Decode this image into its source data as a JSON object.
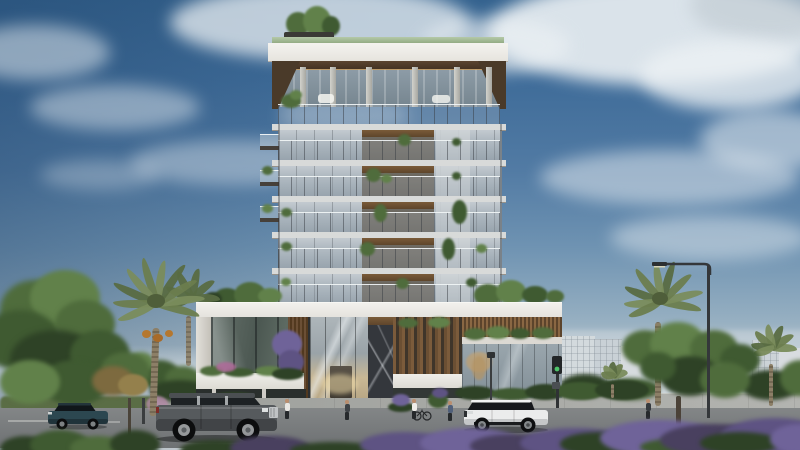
{
  "meta": {
    "description": "Photorealistic architectural rendering of a modern boutique residential tower with glass facade, recessed wood balconies, rooftop garden, landscaped podium, street with palm trees, pedestrians and luxury SUVs",
    "time_of_day": "day",
    "weather": "partly cloudy"
  },
  "palette": {
    "sky_top": "#35638f",
    "sky_mid": "#6f93b2",
    "sky_horizon": "#d7dcdd",
    "cloud": "#ecf1f4",
    "roof_fascia": "#f0efeb",
    "roof_garden_strip": "#a9c29a",
    "soffit_wood": "#4a3a29",
    "balcony_wood": "#6f5334",
    "glass_light": "#c3cad0",
    "glass_dark": "#8b98a2",
    "slab": "#d8dad9",
    "podium_white": "#ecebe7",
    "marble": "#35383d",
    "wood_slat": "#7c5c3c",
    "green_dark": "#2e4226",
    "green_mid": "#4f6c3c",
    "green_bright": "#61814a",
    "purple": "#5e5383",
    "purple_light": "#6f6399",
    "road": "#7c7f80",
    "sidewalk": "#a8aaa6",
    "palm_trunk": "#8c7f67",
    "palm_frond": "#6b7d4e",
    "car_gray": "#565a5d",
    "car_white": "#ebecec",
    "car_teal": "#2c4750",
    "traffic_green": "#4ec46a",
    "lamp_metal": "#34373a"
  },
  "building": {
    "type": "residential tower",
    "tower_floors": 5,
    "penthouse": "double-height glass penthouse with round columns and glass railing",
    "roof": "white fascia slab, green roof garden edge, rooftop trees at left",
    "facade": "floor-to-ceiling glass, recessed wood-lined balconies, potted plants",
    "podium": {
      "entrance": "double-height glass lobby with warm interior light",
      "feature_wall": "dark marble with diagonal veining",
      "screens": "vertical timber slats",
      "planters": "white planter bands with shrubs and purple bougainvillea"
    }
  },
  "street": {
    "vehicles": [
      {
        "type": "full-size luxury SUV",
        "color_name": "graphite gray",
        "facing": "right",
        "position": "center-left"
      },
      {
        "type": "compact SUV",
        "color_name": "dark teal",
        "facing": "left",
        "position": "far-left"
      },
      {
        "type": "luxury SUV",
        "color_name": "white",
        "facing": "left",
        "position": "center-right"
      }
    ],
    "pedestrians": 5,
    "bicycle": true,
    "fixtures": [
      "street lamp",
      "traffic light showing green",
      "pedestrian signal"
    ]
  },
  "vegetation": {
    "left": [
      "large leafy green trees",
      "tall date palm with orange fruit clusters",
      "second smaller palm"
    ],
    "right": [
      "two palm trees",
      "large leafy tree",
      "roadside hedge"
    ],
    "rooftop": [
      "trees over left roof edge"
    ],
    "podium_roof": [
      "shrub clusters flanking tower"
    ],
    "foreground": [
      "purple flowering shrubs",
      "dark green hedges"
    ]
  },
  "background": {
    "right": "low-rise white and glass buildings",
    "left": "dense trees"
  },
  "sky": {
    "condition": "partly cloudy",
    "clouds": "scattered cumulus, denser top-right, hazy near horizon"
  }
}
